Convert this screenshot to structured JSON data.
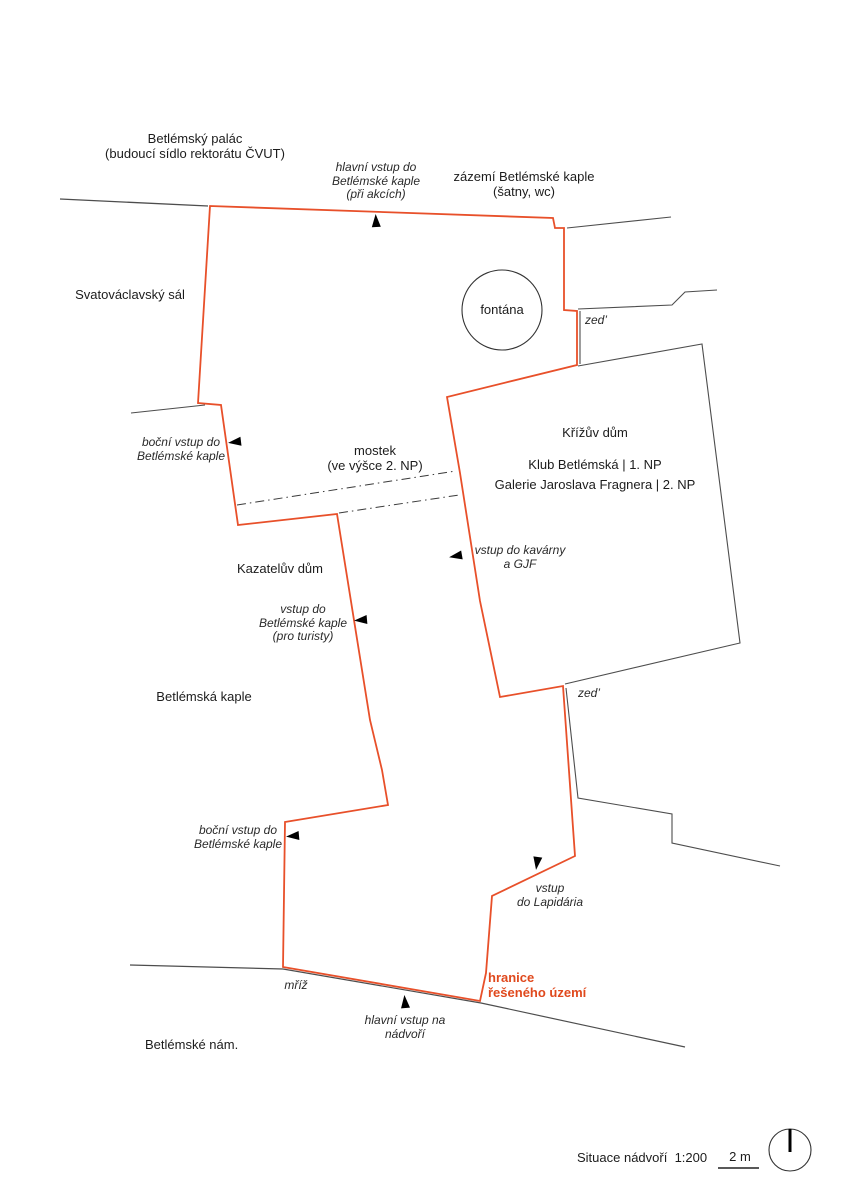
{
  "page": {
    "kind": "architectural site plan",
    "background": "#ffffff"
  },
  "colors": {
    "boundary_orange": "#e8502a",
    "accent_text_orange": "#e0491d",
    "wall_gray": "#555555",
    "text_dark": "#1c1c1c",
    "arrow_black": "#000000"
  },
  "labels": {
    "betlemsky_palac": {
      "lines": [
        "Betlémský palác",
        "(budoucí sídlo rektorátu ČVUT)"
      ]
    },
    "hlavni_vstup_kaple": {
      "lines": [
        "hlavní vstup do",
        "Betlémské kaple",
        "(při akcích)"
      ]
    },
    "zazemi": {
      "lines": [
        "zázemí Betlémské kaple",
        "(šatny, wc)"
      ]
    },
    "svatovaclavsky_sal": {
      "text": "Svatováclavský sál"
    },
    "fontana": {
      "text": "fontána"
    },
    "zed_top": {
      "text": "zed’"
    },
    "bocni_vstup_top": {
      "lines": [
        "boční vstup do",
        "Betlémské kaple"
      ]
    },
    "mostek": {
      "lines": [
        "mostek",
        "(ve výšce 2. NP)"
      ]
    },
    "krizuv_dum": {
      "text": "Křížův dům"
    },
    "klub_betlemska": {
      "text": "Klub Betlémská | 1. NP"
    },
    "galerie_fragnera": {
      "text": "Galerie Jaroslava Fragnera | 2. NP"
    },
    "vstup_kavarna": {
      "lines": [
        "vstup do kavárny",
        "a GJF"
      ]
    },
    "kazateluv_dum": {
      "text": "Kazatelův dům"
    },
    "vstup_turiste": {
      "lines": [
        "vstup do",
        "Betlémské kaple",
        "(pro turisty)"
      ]
    },
    "betlemska_kaple": {
      "text": "Betlémská kaple"
    },
    "zed_bottom": {
      "text": "zed’"
    },
    "bocni_vstup_bottom": {
      "lines": [
        "boční vstup do",
        "Betlémské kaple"
      ]
    },
    "vstup_lapidarium": {
      "lines": [
        "vstup",
        "do Lapidária"
      ]
    },
    "hranice": {
      "lines": [
        "hranice",
        "řešeného území"
      ]
    },
    "mriz": {
      "text": "mříž"
    },
    "hlavni_vstup_nadvori": {
      "lines": [
        "hlavní vstup na",
        "nádvoří"
      ]
    },
    "betlemske_nam": {
      "text": "Betlémské nám."
    }
  },
  "legend": {
    "title": "Situace nádvoří",
    "ratio": "1:200",
    "scale_label": "2 m"
  },
  "icons": {
    "entrance_marker": "solid-black-triangle-arrow",
    "north_indicator": "circle-with-needle",
    "fountain_shape": "circle-outline"
  }
}
